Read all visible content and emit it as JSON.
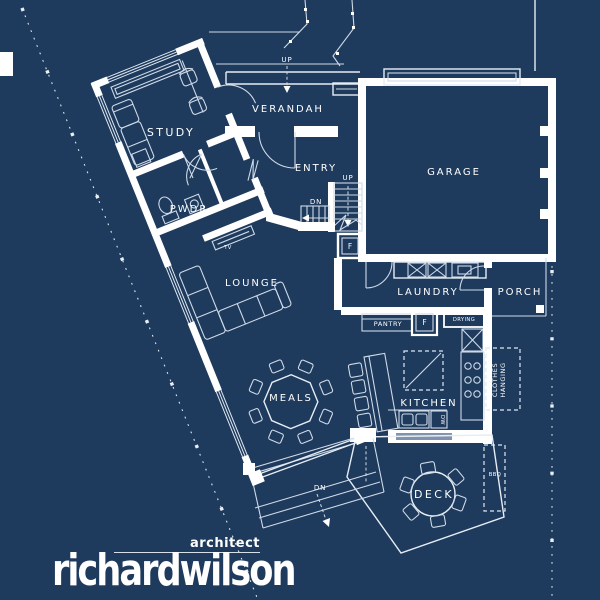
{
  "title": "Ground floor plan blueprint",
  "colors": {
    "background": "#1e3a5c",
    "walls": "#ffffff",
    "thin_lines": "#cfdae8",
    "text": "#ffffff"
  },
  "rooms": {
    "study": "STUDY",
    "pwdr": "PWDR",
    "verandah": "VERANDAH",
    "entry": "ENTRY",
    "garage": "GARAGE",
    "lounge": "LOUNGE",
    "meals": "MEALS",
    "laundry": "LAUNDRY",
    "porch": "PORCH",
    "kitchen": "KITCHEN",
    "deck": "DECK"
  },
  "fixtures": {
    "pantry": "PANTRY",
    "drying": "DRYING",
    "bbq": "BBQ",
    "clothes_line1": "CLOTHES",
    "clothes_line2": "HANGING",
    "fridge": "F",
    "tv": "TV",
    "dishwasher": "DW"
  },
  "annotations": {
    "up": "UP",
    "down": "DN"
  },
  "logo": {
    "name": "richardwilson",
    "profession": "architect"
  }
}
